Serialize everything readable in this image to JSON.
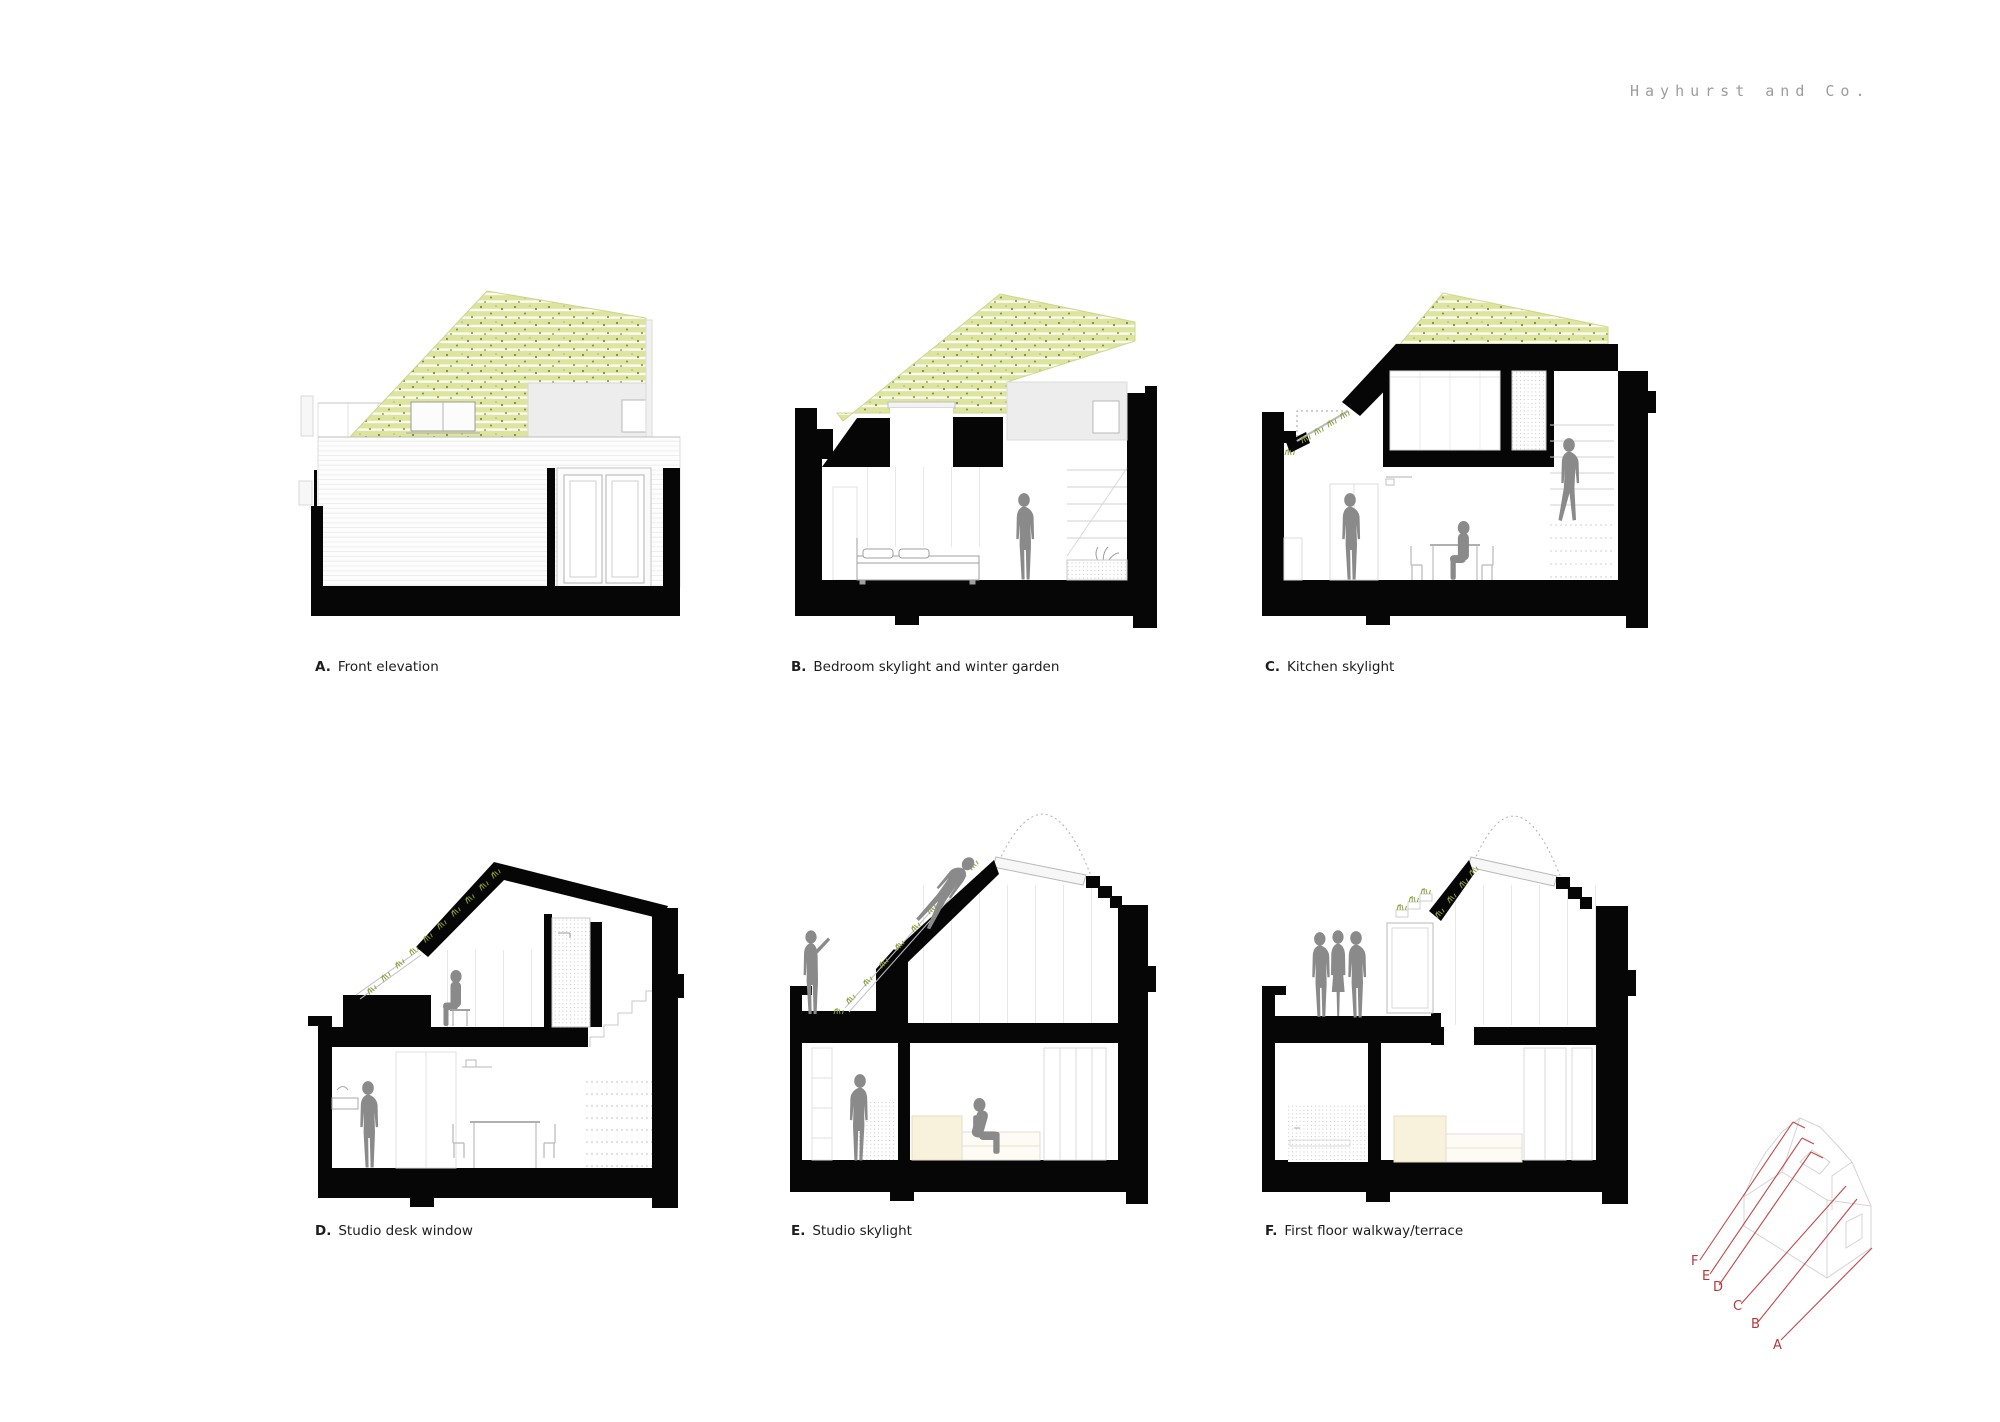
{
  "brand": {
    "name": "Hayhurst and Co."
  },
  "sections": [
    {
      "id": "A",
      "label": "A.",
      "title": "Front elevation"
    },
    {
      "id": "B",
      "label": "B.",
      "title": "Bedroom skylight and winter garden"
    },
    {
      "id": "C",
      "label": "C.",
      "title": "Kitchen skylight"
    },
    {
      "id": "D",
      "label": "D.",
      "title": "Studio desk window"
    },
    {
      "id": "E",
      "label": "E.",
      "title": "Studio skylight"
    },
    {
      "id": "F",
      "label": "F.",
      "title": "First floor walkway/terrace"
    }
  ],
  "key_diagram": {
    "labels": [
      "F",
      "E",
      "D",
      "C",
      "B",
      "A"
    ]
  },
  "colors": {
    "poche_black": "#060606",
    "green_roof": "#dce49e",
    "green_speckle": "#7e8e33",
    "figure_gray": "#8a8a8a",
    "key_red": "#b5383c",
    "logo_gray": "#9d9d9d",
    "sofa_cream": "#f8f1dc",
    "wall_gray": "#ededed"
  }
}
